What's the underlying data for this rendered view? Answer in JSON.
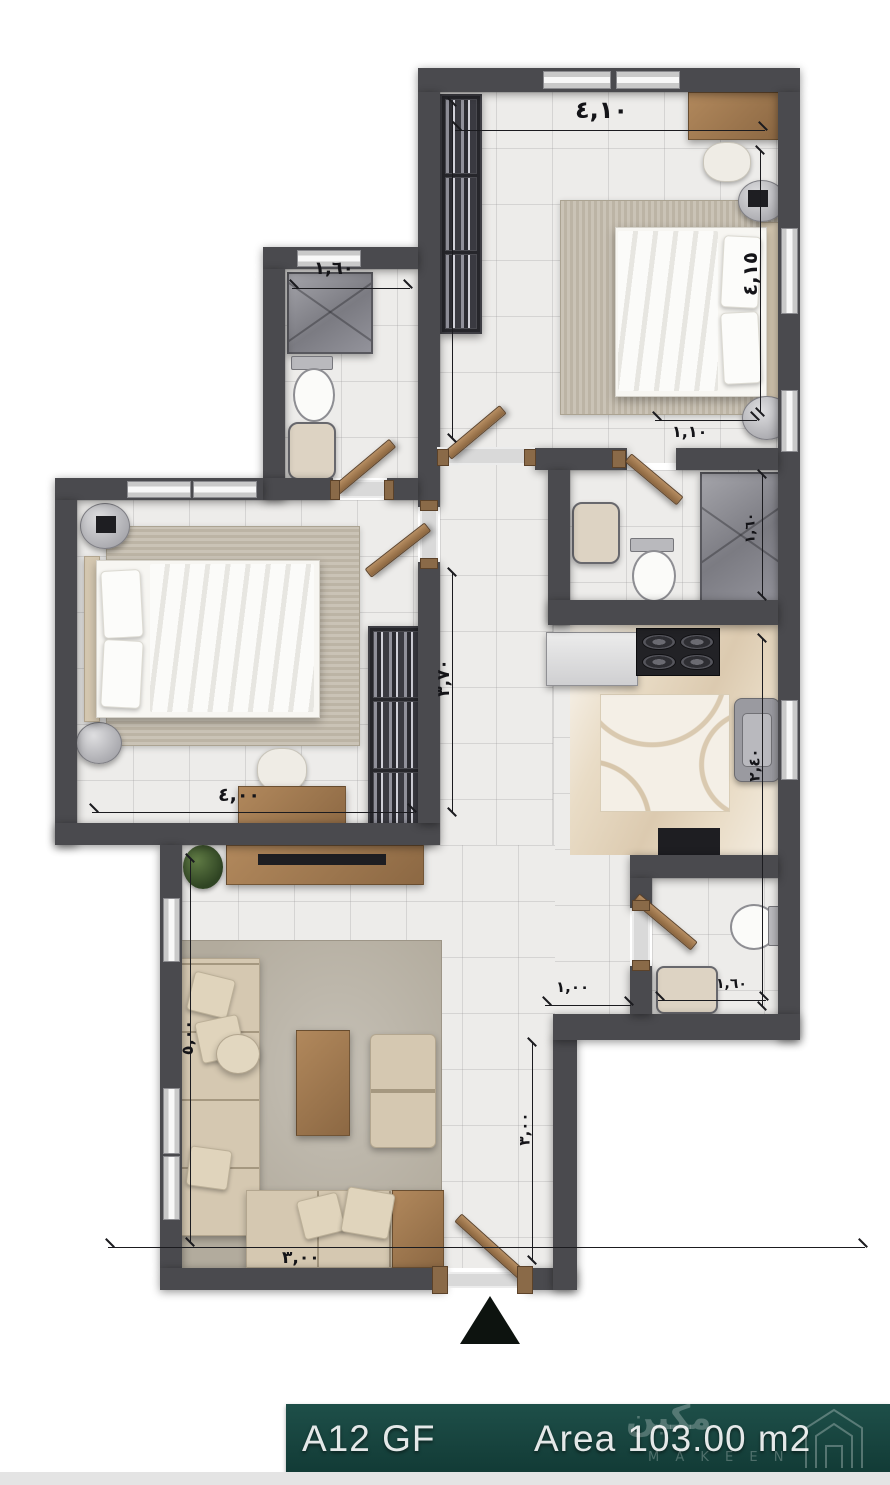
{
  "plan": {
    "unit_label": "A12 GF",
    "area_label": "Area 103.00 m2",
    "watermark": {
      "arabic": "مكين",
      "latin": "M A K E E N"
    },
    "dimensions": {
      "bedroom2_width": "٤,١٠",
      "bedroom2_height": "٤,١٥",
      "bedroom2_nook": "١,١٠",
      "bath2_width": "١,٦٠",
      "bedroom1_width": "٤,٠٠",
      "bedroom1_height": "٣,٧٠",
      "living_width": "٣,٠٠",
      "living_height": "٥,٠٠",
      "entry_width": "١,٠٠",
      "entry_height": "٣,٠٠",
      "kitchen_height": "٢,٤٠",
      "bath1_height": "١,٦٠",
      "wc_width": "١,٦٠"
    },
    "colors": {
      "wall": "#4a4a4e",
      "accent_teal": "#17453f",
      "wood": "#9c7753",
      "floor": "#edecea"
    }
  }
}
